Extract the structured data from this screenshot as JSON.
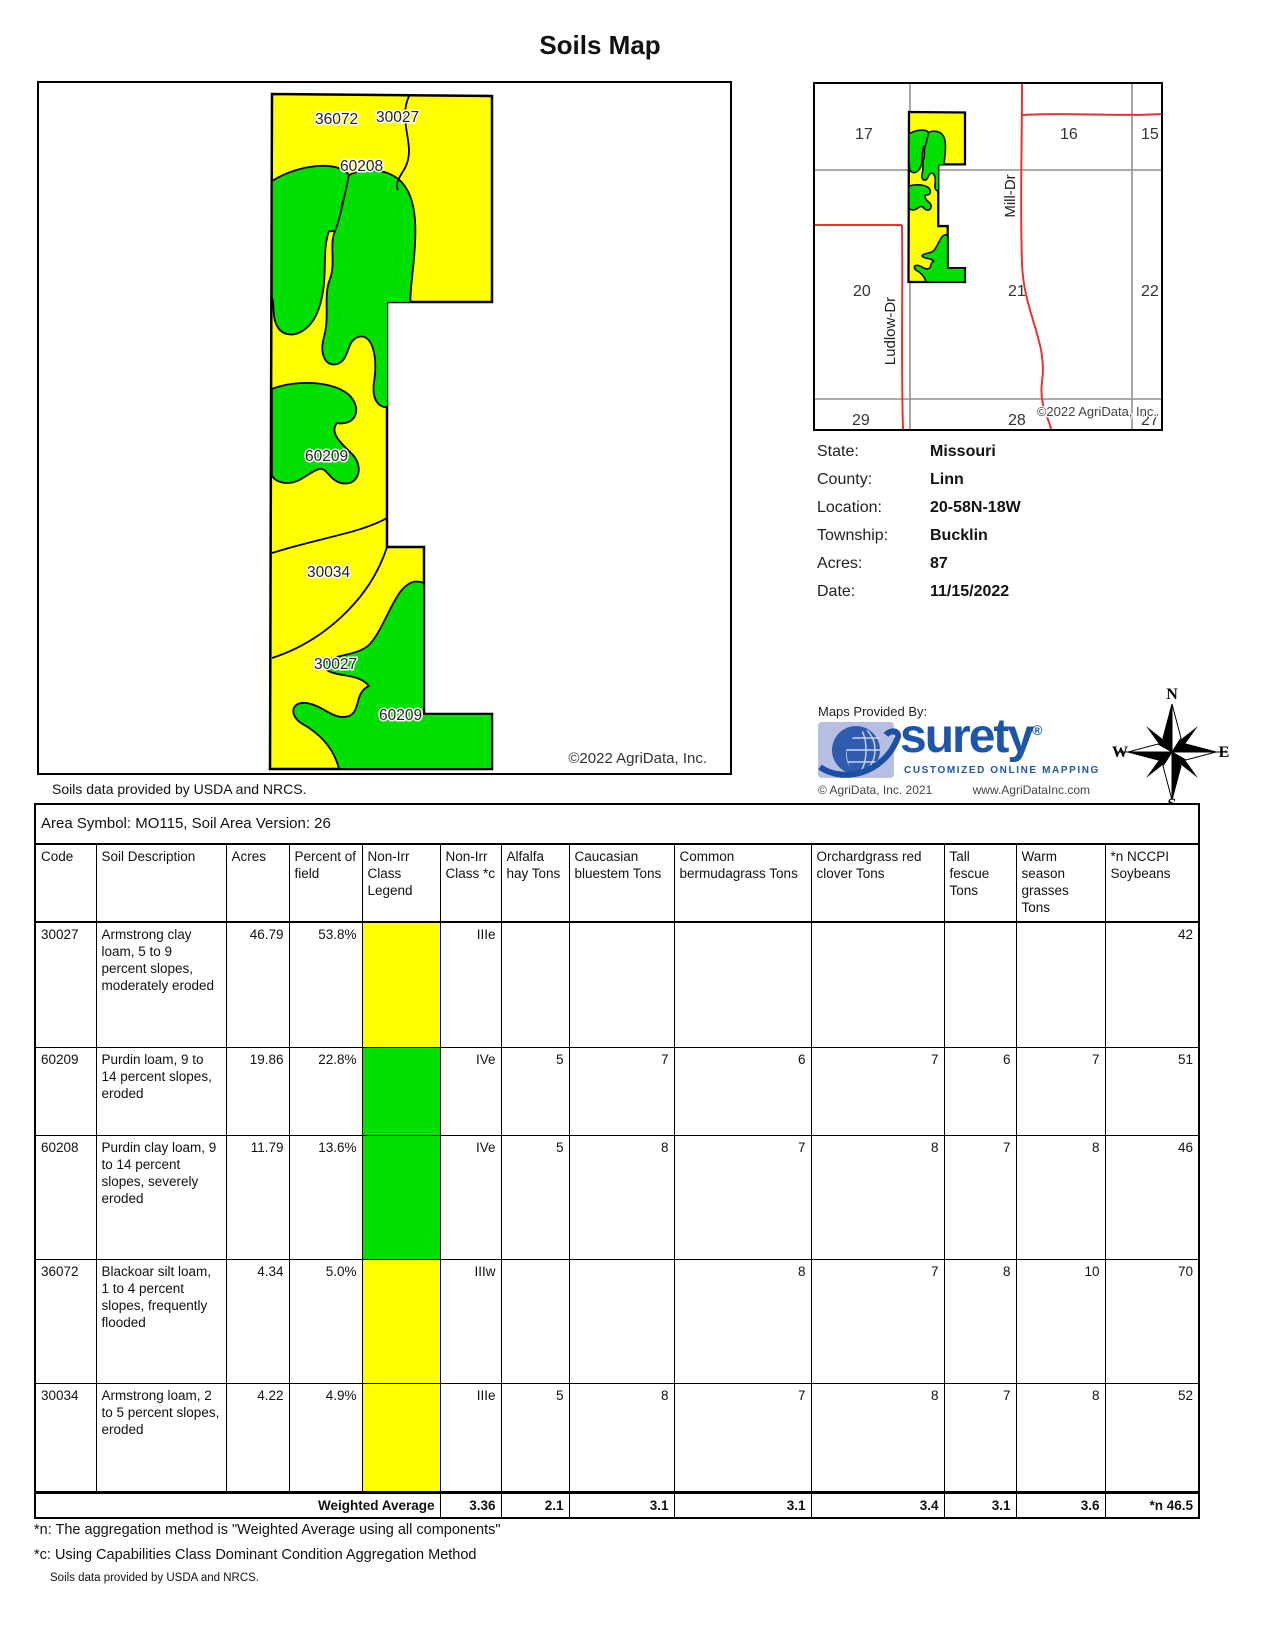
{
  "title": "Soils Map",
  "main_map": {
    "labels": [
      "36072",
      "30027",
      "60208",
      "60209",
      "30034",
      "30027",
      "60209"
    ],
    "copyright": "©2022 AgriData, Inc.",
    "caption": "Soils data provided by USDA and NRCS."
  },
  "inset_map": {
    "sections": [
      "17",
      "16",
      "15",
      "20",
      "21",
      "22",
      "29",
      "28",
      "27"
    ],
    "roads": {
      "mill": "Mill-Dr",
      "ludlow": "Ludlow-Dr"
    },
    "copyright": "©2022 AgriData, Inc."
  },
  "info": {
    "rows": [
      {
        "label": "State:",
        "value": "Missouri"
      },
      {
        "label": "County:",
        "value": "Linn"
      },
      {
        "label": "Location:",
        "value": "20-58N-18W"
      },
      {
        "label": "Township:",
        "value": "Bucklin"
      },
      {
        "label": "Acres:",
        "value": "87"
      },
      {
        "label": "Date:",
        "value": "11/15/2022"
      }
    ]
  },
  "provider": {
    "heading": "Maps Provided By:",
    "brand": "surety",
    "registered": "®",
    "tagline": "CUSTOMIZED ONLINE MAPPING",
    "copyright": "© AgriData, Inc. 2021",
    "website": "www.AgriDataInc.com"
  },
  "compass": {
    "n": "N",
    "s": "S",
    "e": "E",
    "w": "W"
  },
  "table": {
    "area_line": "Area Symbol: MO115, Soil Area Version: 26",
    "columns": [
      "Code",
      "Soil Description",
      "Acres",
      "Percent of field",
      "Non-Irr Class Legend",
      "Non-Irr Class *c",
      "Alfalfa hay Tons",
      "Caucasian bluestem Tons",
      "Common bermudagrass Tons",
      "Orchardgrass red clover Tons",
      "Tall fescue Tons",
      "Warm season grasses Tons",
      "*n NCCPI Soybeans"
    ],
    "rows": [
      {
        "code": "30027",
        "description": "Armstrong clay loam, 5 to 9 percent slopes, moderately eroded",
        "acres": "46.79",
        "percent": "53.8%",
        "legend_color": "#ffff00",
        "class_c": "IIIe",
        "alfalfa": "",
        "caucasian": "",
        "common": "",
        "orchardgrass": "",
        "tall_fescue": "",
        "warm_season": "",
        "nccpi": "42"
      },
      {
        "code": "60209",
        "description": "Purdin loam, 9 to 14 percent slopes, eroded",
        "acres": "19.86",
        "percent": "22.8%",
        "legend_color": "#00e000",
        "class_c": "IVe",
        "alfalfa": "5",
        "caucasian": "7",
        "common": "6",
        "orchardgrass": "7",
        "tall_fescue": "6",
        "warm_season": "7",
        "nccpi": "51"
      },
      {
        "code": "60208",
        "description": "Purdin clay loam, 9 to 14 percent slopes, severely eroded",
        "acres": "11.79",
        "percent": "13.6%",
        "legend_color": "#00e000",
        "class_c": "IVe",
        "alfalfa": "5",
        "caucasian": "8",
        "common": "7",
        "orchardgrass": "8",
        "tall_fescue": "7",
        "warm_season": "8",
        "nccpi": "46"
      },
      {
        "code": "36072",
        "description": "Blackoar silt loam, 1 to 4 percent slopes, frequently flooded",
        "acres": "4.34",
        "percent": "5.0%",
        "legend_color": "#ffff00",
        "class_c": "IIIw",
        "alfalfa": "",
        "caucasian": "",
        "common": "8",
        "orchardgrass": "7",
        "tall_fescue": "8",
        "warm_season": "10",
        "nccpi": "70"
      },
      {
        "code": "30034",
        "description": "Armstrong loam, 2 to 5 percent slopes, eroded",
        "acres": "4.22",
        "percent": "4.9%",
        "legend_color": "#ffff00",
        "class_c": "IIIe",
        "alfalfa": "5",
        "caucasian": "8",
        "common": "7",
        "orchardgrass": "8",
        "tall_fescue": "7",
        "warm_season": "8",
        "nccpi": "52"
      }
    ],
    "weighted": {
      "label": "Weighted Average",
      "class_c": "3.36",
      "alfalfa": "2.1",
      "caucasian": "3.1",
      "common": "3.1",
      "orchardgrass": "3.4",
      "tall_fescue": "3.1",
      "warm_season": "3.6",
      "nccpi": "*n 46.5"
    }
  },
  "footnotes": {
    "n": "*n: The aggregation method is \"Weighted Average using all components\"",
    "c": "*c:  Using Capabilities Class Dominant Condition Aggregation Method",
    "source": "Soils data provided by USDA and NRCS."
  },
  "colors": {
    "soil_yellow": "#ffff00",
    "soil_green": "#00e000",
    "road_red": "#e63232",
    "grid_gray": "#909090",
    "brand_blue": "#1d55a8"
  }
}
